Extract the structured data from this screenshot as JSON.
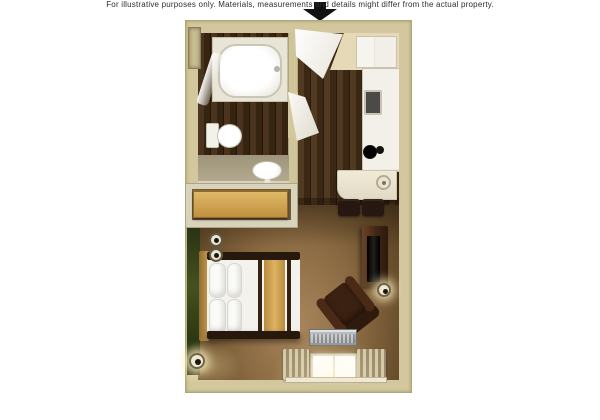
{
  "caption": "For illustrative purposes only.  Materials, measurements and details might differ from the actual property.",
  "entry_arrow": {
    "direction": "down",
    "meaning": "entrance indicator",
    "color": "#111111"
  },
  "floorplan": {
    "kind": "furnished studio suite floor plan, top-down 3D render",
    "rooms": [
      {
        "name": "bathroom",
        "features": [
          "bathtub",
          "shower-curtain",
          "toilet",
          "vanity-sink",
          "wall-niche"
        ]
      },
      {
        "name": "entry-hall",
        "features": [
          "entry-door-open",
          "bathroom-door-open",
          "dark-wood-floor"
        ]
      },
      {
        "name": "kitchen",
        "features": [
          "refrigerator-cabinet",
          "counter-run",
          "kitchen-sink",
          "cooktop-burners",
          "dining-table",
          "table-lamp",
          "two-dining-chairs"
        ]
      },
      {
        "name": "closet-alcove",
        "features": [
          "low-dresser"
        ]
      },
      {
        "name": "studio-bedroom-living",
        "features": [
          "green-accent-wall",
          "queen-bed",
          "four-pillows",
          "tan-bed-runner",
          "two-wall-sconces",
          "corner-floor-lamp",
          "tv-stand",
          "television",
          "floor-lamp-by-tv",
          "armchair",
          "ac-unit",
          "window-two-panes",
          "curtains",
          "carpet"
        ]
      }
    ],
    "colors": {
      "background": "#ffffff",
      "walls_tan": "#d2c79d",
      "carpet_brown": "#8a6a42",
      "wood_floor_dark": "#3f2c18",
      "accent_wall_green": "#3c4a1d",
      "fixtures_white": "#f4f2ea",
      "dark_wood_furniture": "#3a2310",
      "bedding_runner_tan": "#d3a759",
      "arrow_black": "#111111"
    }
  }
}
